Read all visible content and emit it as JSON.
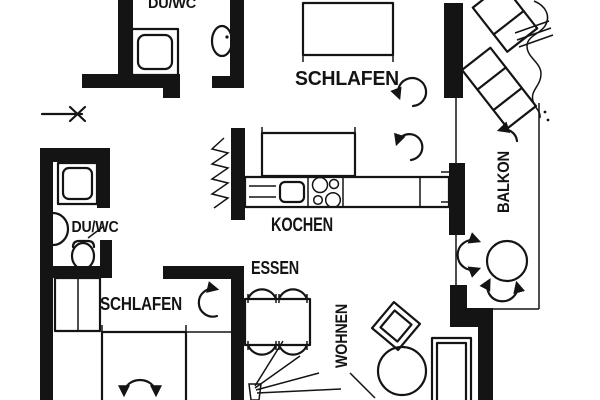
{
  "document": {
    "kind": "architectural floor plan, black ink on white",
    "colors": {
      "ink": "#141414",
      "paper": "#ffffff"
    }
  },
  "labels": {
    "duwc_top": "DU/WC",
    "schlafen_top": "SCHLAFEN",
    "kochen": "KOCHEN",
    "essen": "ESSEN",
    "wohnen": "WOHNEN",
    "balkon": "BALKON",
    "duwc_lower": "DU/WC",
    "schlafen_lower": "SCHLAFEN"
  },
  "symbols": [
    "entrance-arrow",
    "door-swing-arrow",
    "shower",
    "washbasin",
    "toilet",
    "bed",
    "wardrobe",
    "kitchen-counter",
    "sink",
    "cooktop-burners",
    "dining-table",
    "chair-arc",
    "sofa",
    "armchair",
    "coffee-table",
    "balcony-table",
    "lounge-chair",
    "plant",
    "radiator-hatch"
  ]
}
